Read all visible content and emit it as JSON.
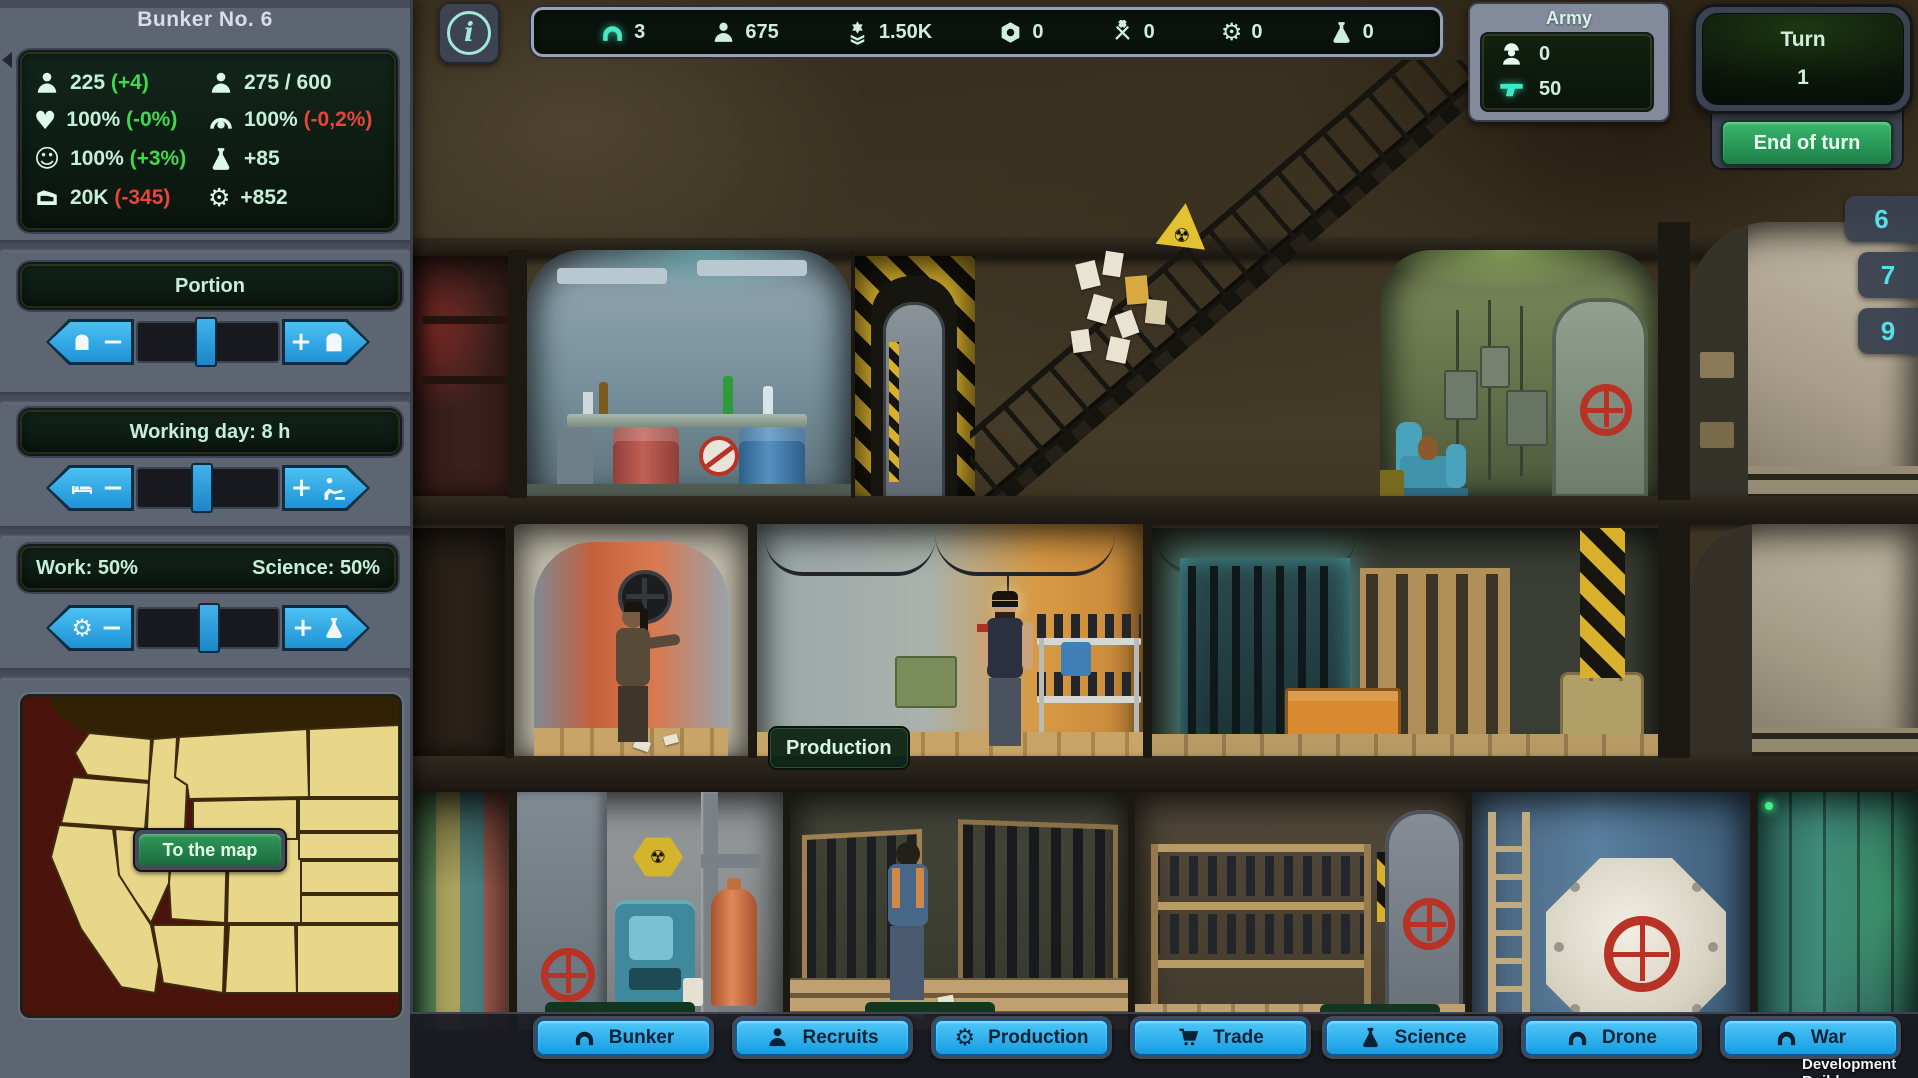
{
  "icons": {
    "info_i": "i",
    "heart": "♥",
    "smiley": "☺",
    "gear": "⚙",
    "radiation": "☢",
    "minus": "−",
    "plus": "+"
  },
  "sidebar": {
    "title": "Bunker No. 6",
    "stats": {
      "population": {
        "value": "225",
        "delta": "(+4)"
      },
      "capacity": {
        "value": "275 / 600"
      },
      "health": {
        "value": "100%",
        "delta": "(-0%)"
      },
      "defense": {
        "value": "100%",
        "delta": "(-0,2%)"
      },
      "happiness": {
        "value": "100%",
        "delta": "(+3%)"
      },
      "science_rate": {
        "value": "+85"
      },
      "money": {
        "value": "20K",
        "delta": "(-345)"
      },
      "production_rate": {
        "value": "+852"
      }
    },
    "portion": {
      "label": "Portion"
    },
    "working_day": {
      "label": "Working day: 8 h"
    },
    "balance": {
      "work": "Work: 50%",
      "science": "Science: 50%"
    },
    "map": {
      "button": "To the map"
    }
  },
  "topbar": {
    "resources": [
      {
        "name": "bunkers",
        "value": "3"
      },
      {
        "name": "population",
        "value": "675"
      },
      {
        "name": "rank",
        "value": "1.50K"
      },
      {
        "name": "nuts",
        "value": "0"
      },
      {
        "name": "tools",
        "value": "0"
      },
      {
        "name": "gears",
        "value": "0"
      },
      {
        "name": "science",
        "value": "0"
      }
    ]
  },
  "army": {
    "title": "Army",
    "soldiers": "0",
    "weapons": "50"
  },
  "turn": {
    "label": "Turn",
    "value": "1",
    "end_button": "End of turn"
  },
  "floor_tabs": [
    "6",
    "7",
    "9"
  ],
  "scene": {
    "production_label": "Production"
  },
  "nav": {
    "items": [
      {
        "label": "Bunker"
      },
      {
        "label": "Recruits"
      },
      {
        "label": "Production"
      },
      {
        "label": "Trade"
      },
      {
        "label": "Science"
      },
      {
        "label": "Drone"
      },
      {
        "label": "War"
      }
    ]
  },
  "footer": {
    "dev_build": "Development Build"
  },
  "colors": {
    "accent_blue": "#2eaee8",
    "mint": "#c6efd9",
    "positive": "#3fd94f",
    "negative": "#e8453a",
    "panel_green": "#0d1f15",
    "army_teal": "#3fe8c8",
    "tab_cyan": "#56dfe6"
  }
}
